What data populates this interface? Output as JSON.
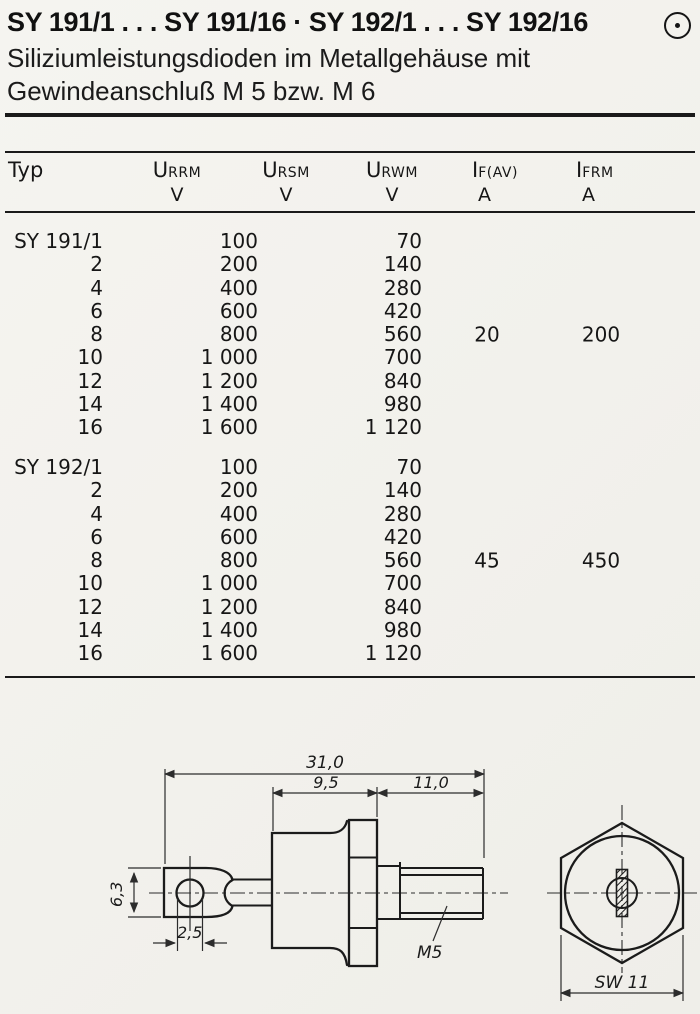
{
  "header": {
    "title": "SY 191/1 . . . SY 191/16 · SY 192/1 . . . SY 192/16",
    "subtitle_line1": "Siliziumleistungsdioden im Metallgehäuse mit",
    "subtitle_line2": "Gewindeanschluß M 5 bzw. M 6",
    "corner_icon": "circle-dot-icon"
  },
  "table": {
    "col_headers": [
      {
        "label": "Typ"
      },
      {
        "symbol": "U",
        "subscript": "RRM",
        "unit": "V"
      },
      {
        "symbol": "U",
        "subscript": "RSM",
        "unit": "V"
      },
      {
        "symbol": "U",
        "subscript": "RWM",
        "unit": "V"
      },
      {
        "symbol": "I",
        "subscript": "F(AV)",
        "unit": "A"
      },
      {
        "symbol": "I",
        "subscript": "FRM",
        "unit": "A"
      }
    ],
    "groups": [
      {
        "series": "SY 191",
        "if_av": "20",
        "ifrm": "200",
        "rows": [
          {
            "typ": "SY 191/1",
            "urrm": "100",
            "urwm": "70"
          },
          {
            "typ": "2",
            "urrm": "200",
            "urwm": "140"
          },
          {
            "typ": "4",
            "urrm": "400",
            "urwm": "280"
          },
          {
            "typ": "6",
            "urrm": "600",
            "urwm": "420"
          },
          {
            "typ": "8",
            "urrm": "800",
            "urwm": "560"
          },
          {
            "typ": "10",
            "urrm": "1 000",
            "urwm": "700"
          },
          {
            "typ": "12",
            "urrm": "1 200",
            "urwm": "840"
          },
          {
            "typ": "14",
            "urrm": "1 400",
            "urwm": "980"
          },
          {
            "typ": "16",
            "urrm": "1 600",
            "urwm": "1 120"
          }
        ]
      },
      {
        "series": "SY 192",
        "if_av": "45",
        "ifrm": "450",
        "rows": [
          {
            "typ": "SY 192/1",
            "urrm": "100",
            "urwm": "70"
          },
          {
            "typ": "2",
            "urrm": "200",
            "urwm": "140"
          },
          {
            "typ": "4",
            "urrm": "400",
            "urwm": "280"
          },
          {
            "typ": "6",
            "urrm": "600",
            "urwm": "420"
          },
          {
            "typ": "8",
            "urrm": "800",
            "urwm": "560"
          },
          {
            "typ": "10",
            "urrm": "1 000",
            "urwm": "700"
          },
          {
            "typ": "12",
            "urrm": "1 200",
            "urwm": "840"
          },
          {
            "typ": "14",
            "urrm": "1 400",
            "urwm": "980"
          },
          {
            "typ": "16",
            "urrm": "1 600",
            "urwm": "1 120"
          }
        ]
      }
    ]
  },
  "drawing": {
    "side_view": {
      "dim_overall_length": "31,0",
      "dim_body_length": "9,5",
      "dim_stud_length": "11,0",
      "dim_lug_height": "6,3",
      "dim_hole": "2,5",
      "thread_label": "M5"
    },
    "end_view": {
      "wrench_size_label": "SW 11"
    }
  }
}
